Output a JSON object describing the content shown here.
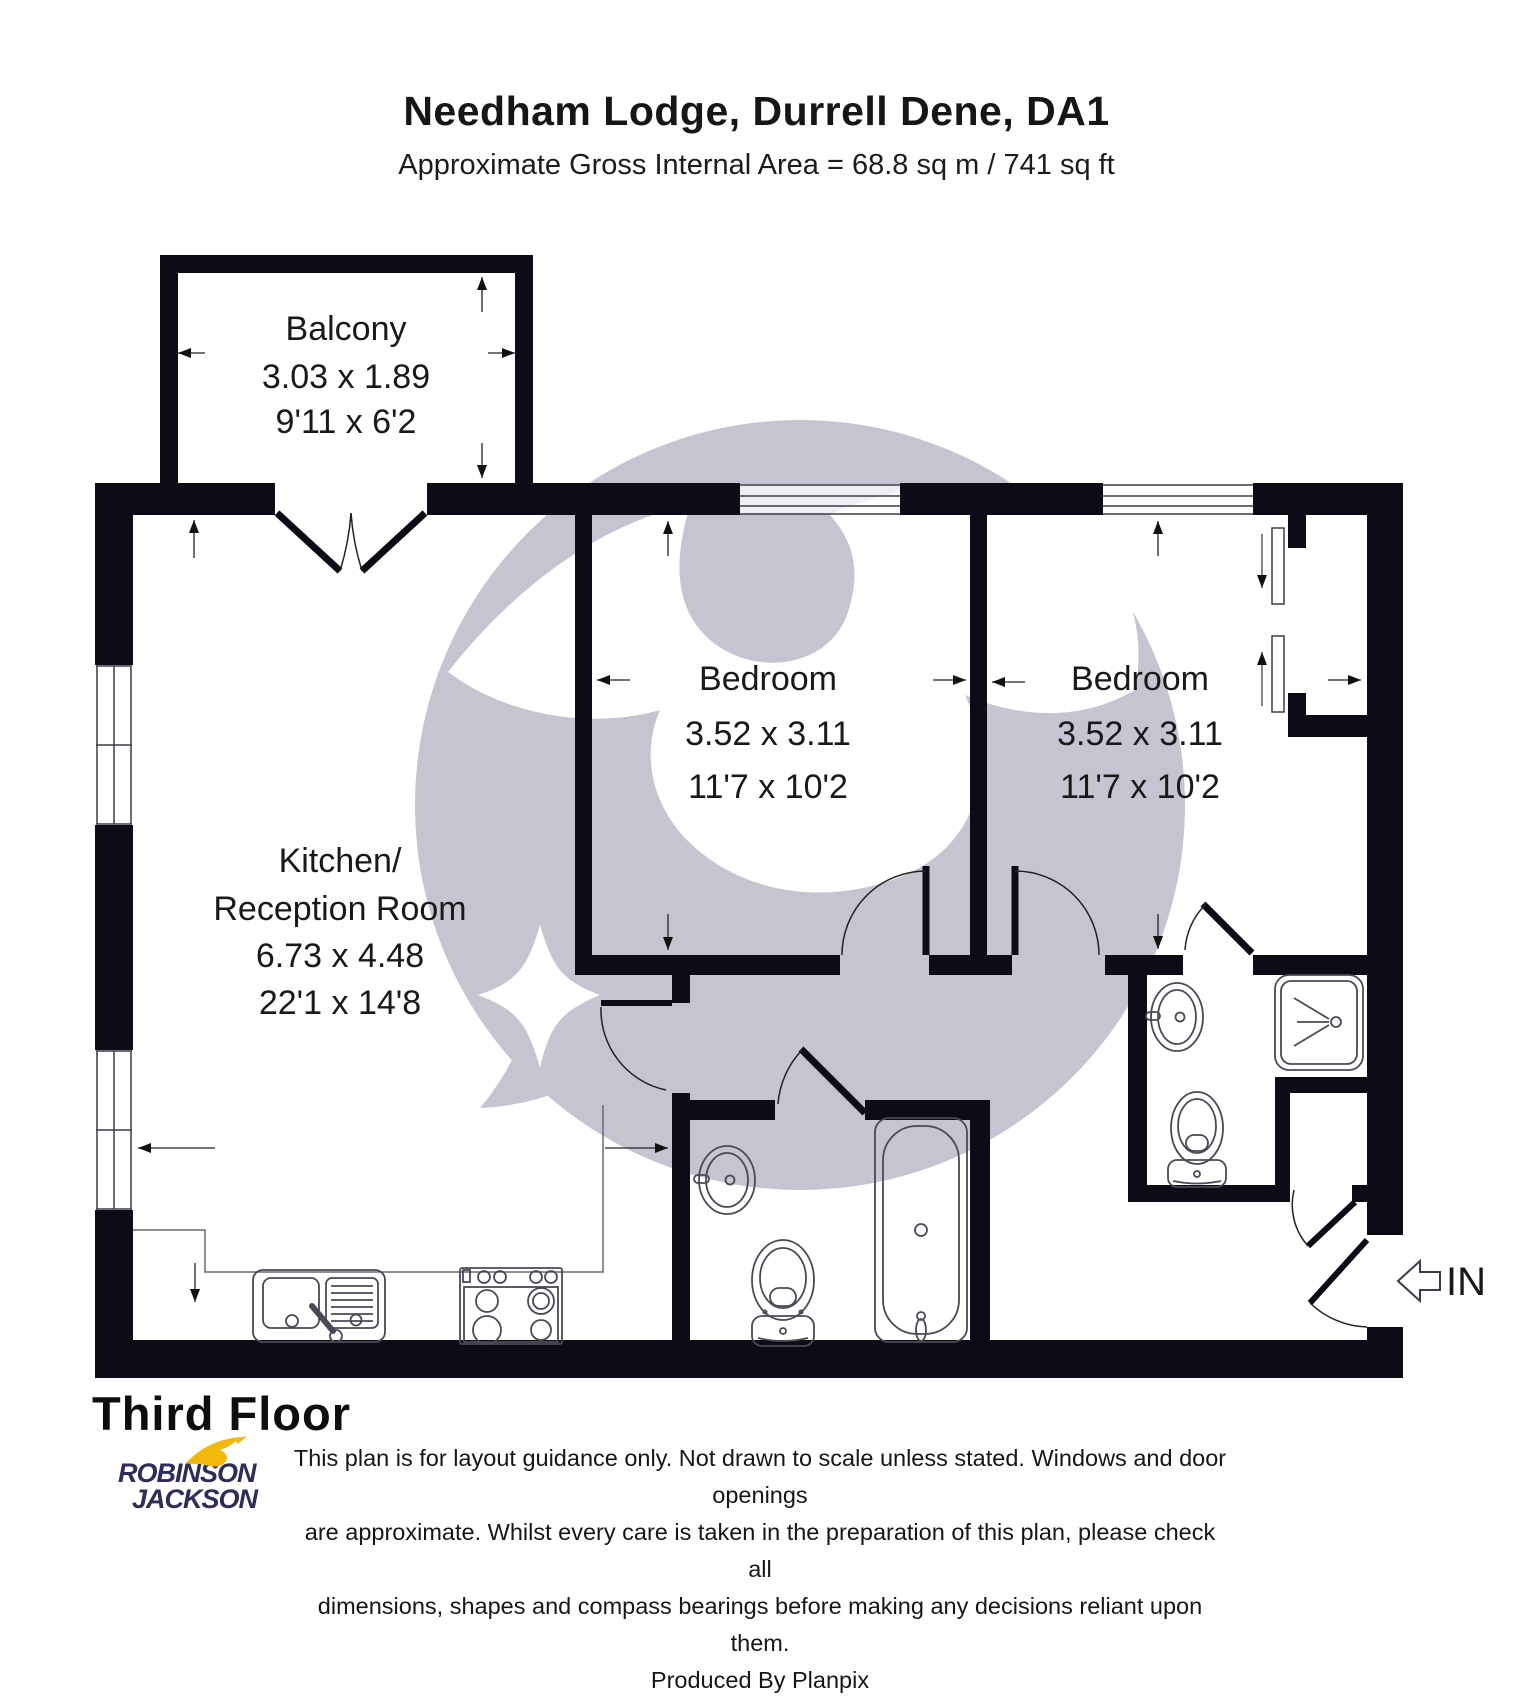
{
  "header": {
    "title": "Needham Lodge, Durrell Dene, DA1",
    "subtitle": "Approximate Gross Internal Area = 68.8 sq m / 741 sq ft"
  },
  "rooms": {
    "balcony": {
      "name": "Balcony",
      "metric": "3.03 x 1.89",
      "imperial": "9'11 x 6'2"
    },
    "bedroom1": {
      "name": "Bedroom",
      "metric": "3.52 x 3.11",
      "imperial": "11'7 x 10'2"
    },
    "bedroom2": {
      "name": "Bedroom",
      "metric": "3.52 x 3.11",
      "imperial": "11'7 x 10'2"
    },
    "kitchen": {
      "name_line1": "Kitchen/",
      "name_line2": "Reception Room",
      "metric": "6.73 x 4.48",
      "imperial": "22'1 x 14'8"
    }
  },
  "entrance": {
    "label": "IN"
  },
  "footer": {
    "floor_label": "Third Floor",
    "brand": {
      "line1": "ROBINSON",
      "line2": "JACKSON"
    },
    "disclaimer": {
      "line1": "This plan is for layout guidance only. Not drawn to scale unless stated. Windows and door openings",
      "line2": "are approximate. Whilst every care is taken in the preparation of this plan, please check all",
      "line3": "dimensions, shapes and compass bearings before making any decisions reliant upon them.",
      "line4": "Produced By Planpix"
    }
  },
  "icons": {
    "entrance-arrow-icon": "hollow left arrow",
    "swallow-icon": "yellow swallow bird",
    "fixtures": [
      "toilet-icon",
      "bathtub-icon",
      "shower-icon",
      "basin-icon",
      "kitchen-sink-icon",
      "hob-icon",
      "wardrobe-sliding-doors-icon"
    ]
  },
  "colors": {
    "wall": "#0c0c16",
    "watermark": "#c5c5d1",
    "brand_navy": "#2d2d5a",
    "brand_yellow": "#f2b90a",
    "background": "#ffffff"
  }
}
